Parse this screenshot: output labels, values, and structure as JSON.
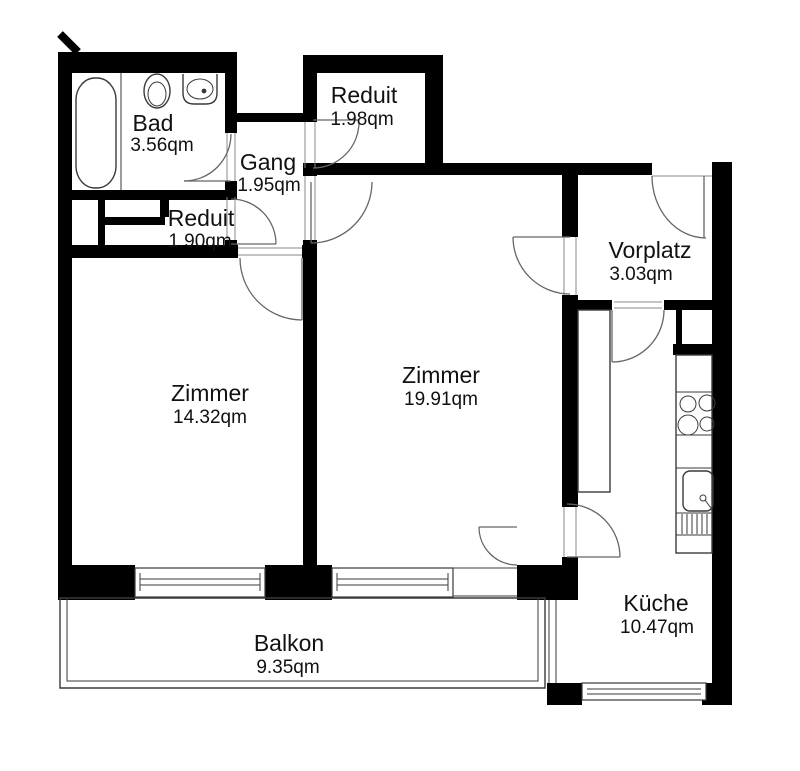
{
  "plan": {
    "title": "apartment-floorplan",
    "unit": "qm",
    "wall_color": "#000000",
    "line_color": "#3a3a3a",
    "door_color": "#666666",
    "text_color": "#111111",
    "background": "#ffffff"
  },
  "rooms": {
    "bad": {
      "name": "Bad",
      "area": "3.56qm"
    },
    "gang": {
      "name": "Gang",
      "area": "1.95qm"
    },
    "reduit_top": {
      "name": "Reduit",
      "area": "1.98qm"
    },
    "reduit_small": {
      "name": "Reduit",
      "area": "1.90qm"
    },
    "zimmer_left": {
      "name": "Zimmer",
      "area": "14.32qm"
    },
    "zimmer_center": {
      "name": "Zimmer",
      "area": "19.91qm"
    },
    "vorplatz": {
      "name": "Vorplatz",
      "area": "3.03qm"
    },
    "kueche": {
      "name": "Küche",
      "area": "10.47qm"
    },
    "balkon": {
      "name": "Balkon",
      "area": "9.35qm"
    }
  },
  "fixtures": [
    "bathtub",
    "washbasin-oval",
    "washbasin-rect",
    "kitchen-counter-left",
    "kitchen-counter-right",
    "stove-4-burners",
    "kitchen-sink",
    "dishwasher-drawers",
    "wardrobe-niche",
    "shaft"
  ],
  "doors": [
    "bad-door",
    "reduit-small-door",
    "zimmer-left-door",
    "reduit-top-door",
    "zimmer-center-door",
    "entrance-door",
    "vorplatz-zimmer-door",
    "kueche-door",
    "kueche-balcony-door",
    "zimmer-balcony-door"
  ]
}
